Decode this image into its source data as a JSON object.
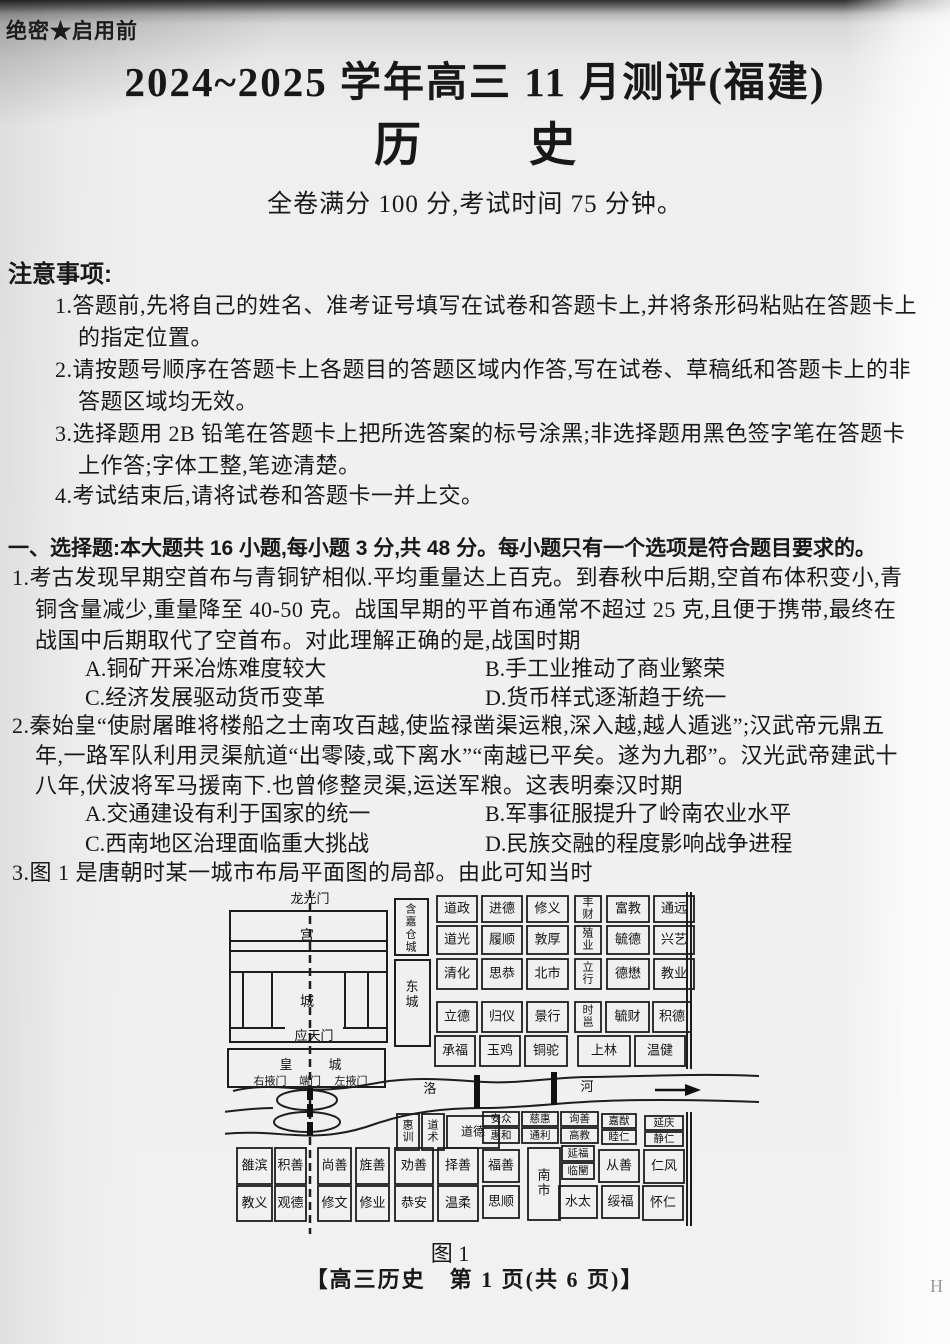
{
  "page": {
    "security_label": "绝密★启用前",
    "title": "2024~2025 学年高三 11 月测评(福建)",
    "subject_left": "历",
    "subject_right": "史",
    "score_line": "全卷满分 100 分,考试时间 75 分钟。",
    "footer": "【高三历史　第 1 页(共 6 页)】",
    "footer_mark": "H"
  },
  "notice": {
    "heading": "注意事项:",
    "lines": [
      "1.答题前,先将自己的姓名、准考证号填写在试卷和答题卡上,并将条形码粘贴在答题卡上",
      "的指定位置。",
      "2.请按题号顺序在答题卡上各题目的答题区域内作答,写在试卷、草稿纸和答题卡上的非",
      "答题区域均无效。",
      "3.选择题用 2B 铅笔在答题卡上把所选答案的标号涂黑;非选择题用黑色签字笔在答题卡",
      "上作答;字体工整,笔迹清楚。",
      "4.考试结束后,请将试卷和答题卡一并上交。"
    ]
  },
  "section1": {
    "heading": "一、选择题:本大题共 16 小题,每小题 3 分,共 48 分。每小题只有一个选项是符合题目要求的。"
  },
  "q1": {
    "stem_lines": [
      "1.考古发现早期空首布与青铜铲相似.平均重量达上百克。到春秋中后期,空首布体积变小,青",
      "铜含量减少,重量降至 40-50 克。战国早期的平首布通常不超过 25 克,且便于携带,最终在",
      "战国中后期取代了空首布。对此理解正确的是,战国时期"
    ],
    "option_a": "A.铜矿开采冶炼难度较大",
    "option_b": "B.手工业推动了商业繁荣",
    "option_c": "C.经济发展驱动货币变革",
    "option_d": "D.货币样式逐渐趋于统一"
  },
  "q2": {
    "stem_lines": [
      "2.秦始皇“使尉屠睢将楼船之士南攻百越,使监禄凿渠运粮,深入越,越人遁逃”;汉武帝元鼎五",
      "年,一路军队利用灵渠航道“出零陵,或下离水”“南越已平矣。遂为九郡”。汉光武帝建武十",
      "八年,伏波将军马援南下.也曾修整灵渠,运送军粮。这表明秦汉时期"
    ],
    "option_a": "A.交通建设有利于国家的统一",
    "option_b": "B.军事征服提升了岭南农业水平",
    "option_c": "C.西南地区治理面临重大挑战",
    "option_d": "D.民族交融的程度影响战争进程"
  },
  "q3": {
    "stem": "3.图 1 是唐朝时某一城市布局平面图的局部。由此可知当时",
    "caption": "图 1"
  },
  "figure": {
    "wards": [
      {
        "x": 212,
        "y": 12,
        "w": 40,
        "h": 26,
        "t": "道政"
      },
      {
        "x": 257,
        "y": 12,
        "w": 40,
        "h": 26,
        "t": "进德"
      },
      {
        "x": 302,
        "y": 12,
        "w": 41,
        "h": 26,
        "t": "修义"
      },
      {
        "x": 212,
        "y": 42,
        "w": 40,
        "h": 28,
        "t": "道光"
      },
      {
        "x": 257,
        "y": 42,
        "w": 40,
        "h": 28,
        "t": "履顺"
      },
      {
        "x": 302,
        "y": 42,
        "w": 41,
        "h": 28,
        "t": "敦厚"
      },
      {
        "x": 212,
        "y": 75,
        "w": 40,
        "h": 30,
        "t": "清化"
      },
      {
        "x": 257,
        "y": 75,
        "w": 40,
        "h": 30,
        "t": "思恭"
      },
      {
        "x": 302,
        "y": 75,
        "w": 41,
        "h": 30,
        "t": "北市"
      },
      {
        "x": 212,
        "y": 118,
        "w": 40,
        "h": 30,
        "t": "立德"
      },
      {
        "x": 257,
        "y": 118,
        "w": 40,
        "h": 30,
        "t": "归仪"
      },
      {
        "x": 302,
        "y": 118,
        "w": 41,
        "h": 30,
        "t": "景行"
      },
      {
        "x": 210,
        "y": 152,
        "w": 40,
        "h": 30,
        "t": "承福"
      },
      {
        "x": 255,
        "y": 152,
        "w": 40,
        "h": 30,
        "t": "玉鸡"
      },
      {
        "x": 300,
        "y": 152,
        "w": 42,
        "h": 30,
        "t": "铜驼"
      },
      {
        "x": 350,
        "y": 12,
        "w": 26,
        "h": 26,
        "t": "丰财",
        "v": 1,
        "fs": 11
      },
      {
        "x": 382,
        "y": 12,
        "w": 42,
        "h": 26,
        "t": "富教"
      },
      {
        "x": 429,
        "y": 12,
        "w": 40,
        "h": 26,
        "t": "通远"
      },
      {
        "x": 350,
        "y": 42,
        "w": 26,
        "h": 28,
        "t": "殖业",
        "v": 1,
        "fs": 11
      },
      {
        "x": 382,
        "y": 42,
        "w": 42,
        "h": 28,
        "t": "毓德"
      },
      {
        "x": 429,
        "y": 42,
        "w": 40,
        "h": 28,
        "t": "兴艺"
      },
      {
        "x": 350,
        "y": 75,
        "w": 26,
        "h": 30,
        "t": "立行",
        "v": 1,
        "fs": 11
      },
      {
        "x": 382,
        "y": 75,
        "w": 42,
        "h": 30,
        "t": "德懋"
      },
      {
        "x": 429,
        "y": 75,
        "w": 40,
        "h": 30,
        "t": "教业"
      },
      {
        "x": 350,
        "y": 118,
        "w": 26,
        "h": 30,
        "t": "时邕",
        "v": 1,
        "fs": 11
      },
      {
        "x": 381,
        "y": 118,
        "w": 43,
        "h": 30,
        "t": "毓财"
      },
      {
        "x": 428,
        "y": 118,
        "w": 38,
        "h": 30,
        "t": "积德"
      },
      {
        "x": 353,
        "y": 152,
        "w": 52,
        "h": 30,
        "t": "上林"
      },
      {
        "x": 410,
        "y": 152,
        "w": 50,
        "h": 30,
        "t": "温健"
      },
      {
        "x": 172,
        "y": 230,
        "w": 22,
        "h": 36,
        "t": "惠训",
        "v": 1,
        "fs": 11
      },
      {
        "x": 197,
        "y": 230,
        "w": 22,
        "h": 36,
        "t": "道术",
        "v": 1,
        "fs": 11
      },
      {
        "x": 222,
        "y": 232,
        "w": 52,
        "h": 32,
        "t": "道德",
        "fs": 12
      },
      {
        "x": 258,
        "y": 228,
        "w": 36,
        "h": 14,
        "t": "安众",
        "fs": 10.5
      },
      {
        "x": 258,
        "y": 244,
        "w": 36,
        "h": 15,
        "t": "惠和",
        "fs": 10.5
      },
      {
        "x": 297,
        "y": 228,
        "w": 36,
        "h": 14,
        "t": "慈惠",
        "fs": 10.5
      },
      {
        "x": 297,
        "y": 244,
        "w": 36,
        "h": 15,
        "t": "通利",
        "fs": 10.5
      },
      {
        "x": 336,
        "y": 228,
        "w": 37,
        "h": 14,
        "t": "询善",
        "fs": 10.5
      },
      {
        "x": 336,
        "y": 244,
        "w": 37,
        "h": 15,
        "t": "高教",
        "fs": 10.5
      },
      {
        "x": 377,
        "y": 230,
        "w": 34,
        "h": 14,
        "t": "嘉猷",
        "fs": 10.5
      },
      {
        "x": 377,
        "y": 246,
        "w": 34,
        "h": 14,
        "t": "睦仁",
        "fs": 10.5
      },
      {
        "x": 420,
        "y": 232,
        "w": 38,
        "h": 14,
        "t": "延庆",
        "fs": 10.5
      },
      {
        "x": 420,
        "y": 248,
        "w": 38,
        "h": 14,
        "t": "静仁",
        "fs": 10.5
      },
      {
        "x": 12,
        "y": 264,
        "w": 35,
        "h": 36,
        "t": "雒滨"
      },
      {
        "x": 50,
        "y": 264,
        "w": 31,
        "h": 36,
        "t": "积善"
      },
      {
        "x": 93,
        "y": 264,
        "w": 33,
        "h": 36,
        "t": "尚善"
      },
      {
        "x": 131,
        "y": 264,
        "w": 33,
        "h": 36,
        "t": "旌善"
      },
      {
        "x": 170,
        "y": 264,
        "w": 38,
        "h": 36,
        "t": "劝善"
      },
      {
        "x": 213,
        "y": 264,
        "w": 40,
        "h": 36,
        "t": "择善"
      },
      {
        "x": 258,
        "y": 266,
        "w": 36,
        "h": 32,
        "t": "福善"
      },
      {
        "x": 303,
        "y": 264,
        "w": 32,
        "h": 72,
        "t": "南市",
        "v": 1
      },
      {
        "x": 337,
        "y": 262,
        "w": 32,
        "h": 15,
        "t": "延福",
        "fs": 10.5
      },
      {
        "x": 337,
        "y": 279,
        "w": 32,
        "h": 16,
        "t": "临闉",
        "fs": 10.5
      },
      {
        "x": 374,
        "y": 266,
        "w": 40,
        "h": 32,
        "t": "从善"
      },
      {
        "x": 419,
        "y": 266,
        "w": 40,
        "h": 33,
        "t": "仁风"
      },
      {
        "x": 12,
        "y": 302,
        "w": 35,
        "h": 35,
        "t": "教义"
      },
      {
        "x": 50,
        "y": 302,
        "w": 31,
        "h": 35,
        "t": "观德"
      },
      {
        "x": 93,
        "y": 302,
        "w": 33,
        "h": 35,
        "t": "修文"
      },
      {
        "x": 131,
        "y": 302,
        "w": 33,
        "h": 35,
        "t": "修业"
      },
      {
        "x": 170,
        "y": 302,
        "w": 38,
        "h": 35,
        "t": "恭安"
      },
      {
        "x": 213,
        "y": 302,
        "w": 40,
        "h": 35,
        "t": "温柔"
      },
      {
        "x": 258,
        "y": 302,
        "w": 36,
        "h": 32,
        "t": "思顺"
      },
      {
        "x": 334,
        "y": 302,
        "w": 38,
        "h": 32,
        "t": "水太"
      },
      {
        "x": 377,
        "y": 302,
        "w": 37,
        "h": 32,
        "t": "绥福"
      },
      {
        "x": 418,
        "y": 302,
        "w": 40,
        "h": 34,
        "t": "怀仁"
      }
    ],
    "labels": [
      {
        "x": 85,
        "y": 16,
        "t": "龙光门",
        "fs": 13
      },
      {
        "x": 82,
        "y": 53,
        "t": "宫",
        "fs": 14
      },
      {
        "x": 82,
        "y": 119,
        "t": "城",
        "fs": 14
      },
      {
        "x": 89,
        "y": 153,
        "t": "应天门",
        "fs": 13
      },
      {
        "x": 61,
        "y": 182,
        "t": "皇",
        "fs": 13
      },
      {
        "x": 110,
        "y": 182,
        "t": "城",
        "fs": 13
      },
      {
        "x": 45,
        "y": 198,
        "t": "右掖门",
        "fs": 11
      },
      {
        "x": 85,
        "y": 198,
        "t": "端门",
        "fs": 11
      },
      {
        "x": 126,
        "y": 198,
        "t": "左掖门",
        "fs": 11
      },
      {
        "x": 205,
        "y": 206,
        "t": "洛",
        "fs": 13
      },
      {
        "x": 362,
        "y": 204,
        "t": "河",
        "fs": 13
      },
      {
        "x": 186,
        "y": 26,
        "t": "含嘉仓城",
        "fs": 11,
        "vert": 1
      },
      {
        "x": 187,
        "y": 104,
        "t": "东城",
        "fs": 13,
        "vert": 1
      }
    ]
  }
}
